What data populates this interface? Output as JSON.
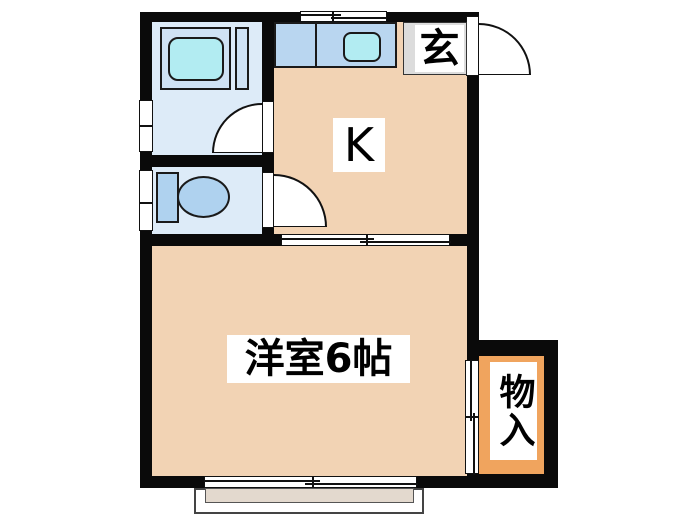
{
  "floorplan": {
    "labels": {
      "entrance": "玄",
      "kitchen": "K",
      "western_room": "洋室6帖",
      "closet": "物入"
    },
    "colors": {
      "wall": "#0a0a0a",
      "room_fill": "#f2d3b4",
      "wet_area_fill": "#ddebf8",
      "fixture_blue": "#b9d6f0",
      "tub_shell_blue": "#cfe2f4",
      "basin_cyan": "#b2ecf2",
      "toilet_blue": "#afd2ef",
      "closet_orange": "#f0a45e",
      "entrance_grey": "#dcdcdc",
      "balcony_fill": "#e3d9ce"
    }
  }
}
